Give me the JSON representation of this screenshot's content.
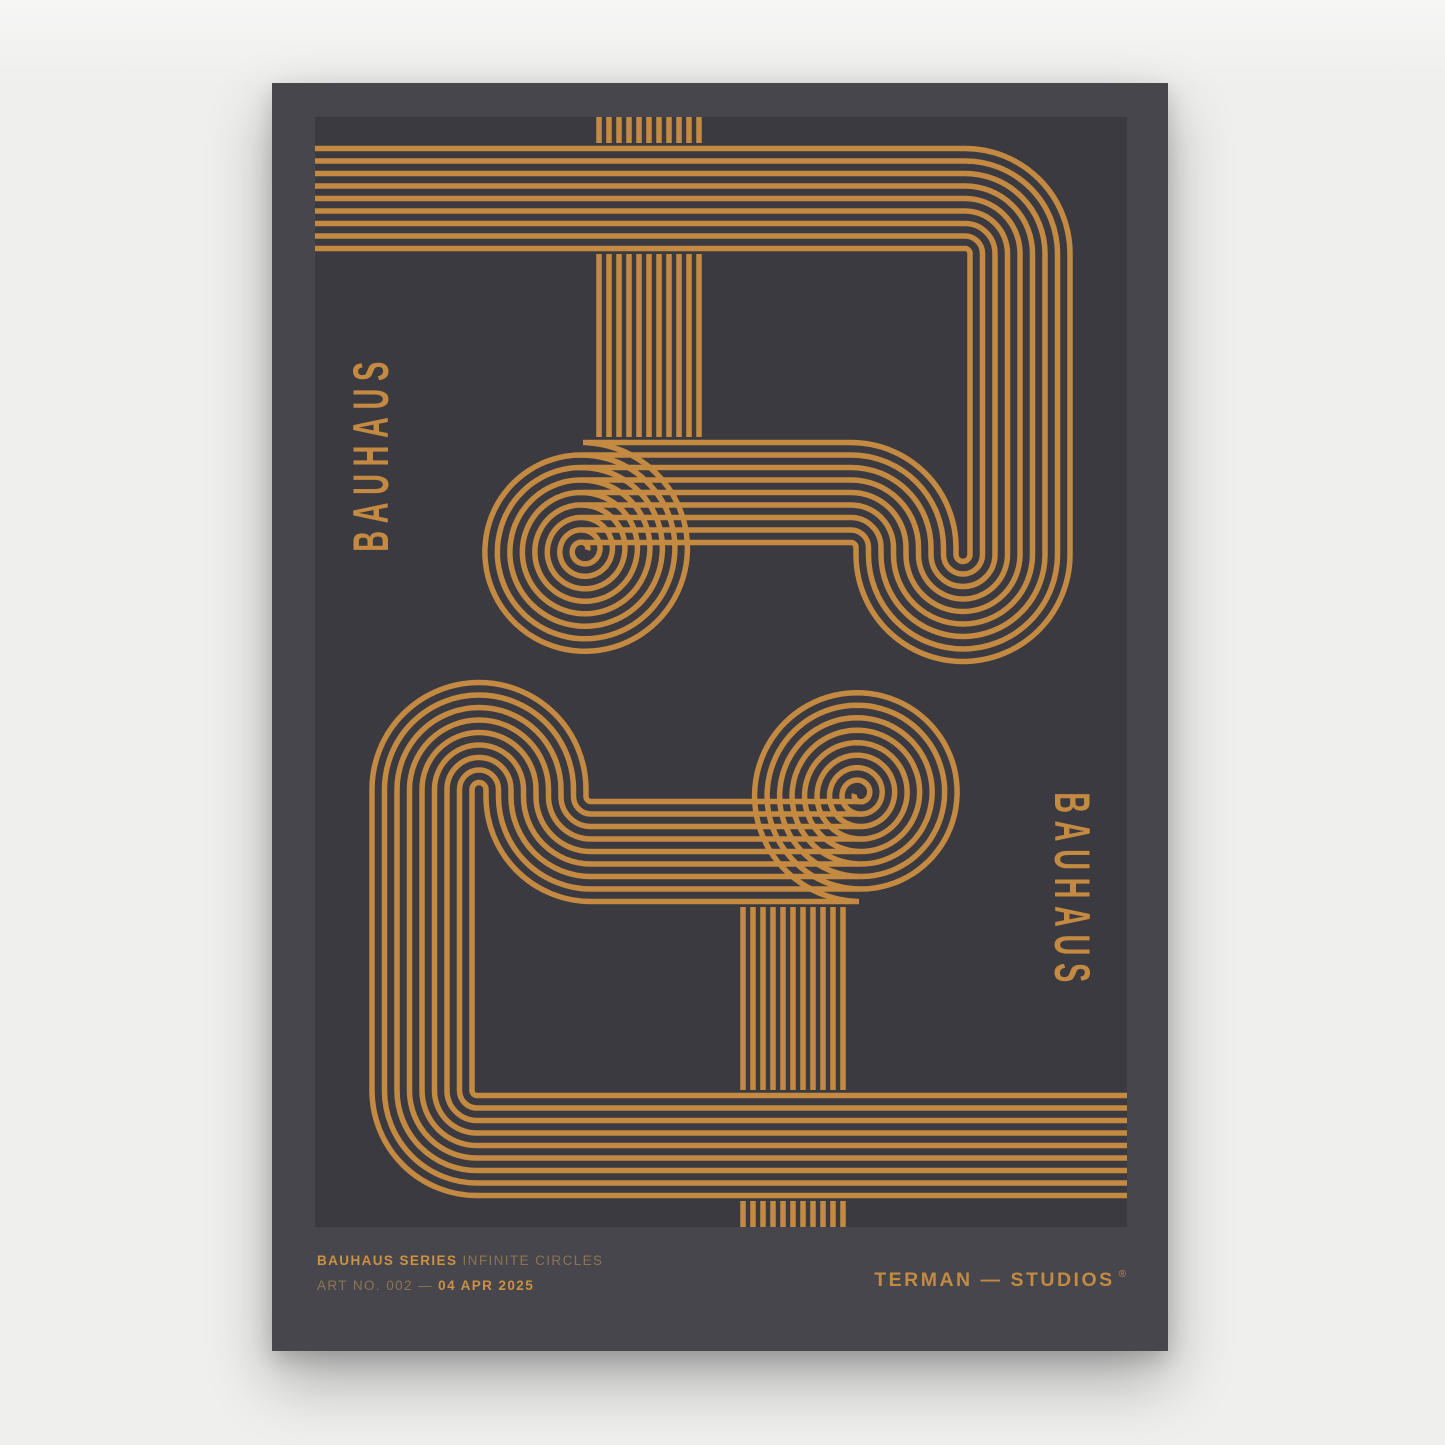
{
  "poster": {
    "side_text_left": "BAUHAUS",
    "side_text_right": "BAUHAUS",
    "footer": {
      "series_bold": "BAUHAUS SERIES",
      "series_rest": "INFINITE CIRCLES",
      "artno_prefix": "ART NO. 002 —",
      "artno_date": "04 APR 2025",
      "studio": "TERMAN — STUDIOS",
      "studio_mark": "®"
    },
    "colors": {
      "page_bg": "#efefee",
      "poster_bg": "#46464c",
      "panel_bg": "#3b3a41",
      "line_gold": "#c48a41",
      "text_gold": "#c48a41",
      "text_gold_bright": "#cc9143",
      "text_gold_muted": "#8d7454"
    },
    "artwork": {
      "description": "two interlocked striped tube glyphs with rolled spiral ends, 180-degree rotational symmetry",
      "lines_per_band": 9,
      "comb_lines": 11
    }
  }
}
